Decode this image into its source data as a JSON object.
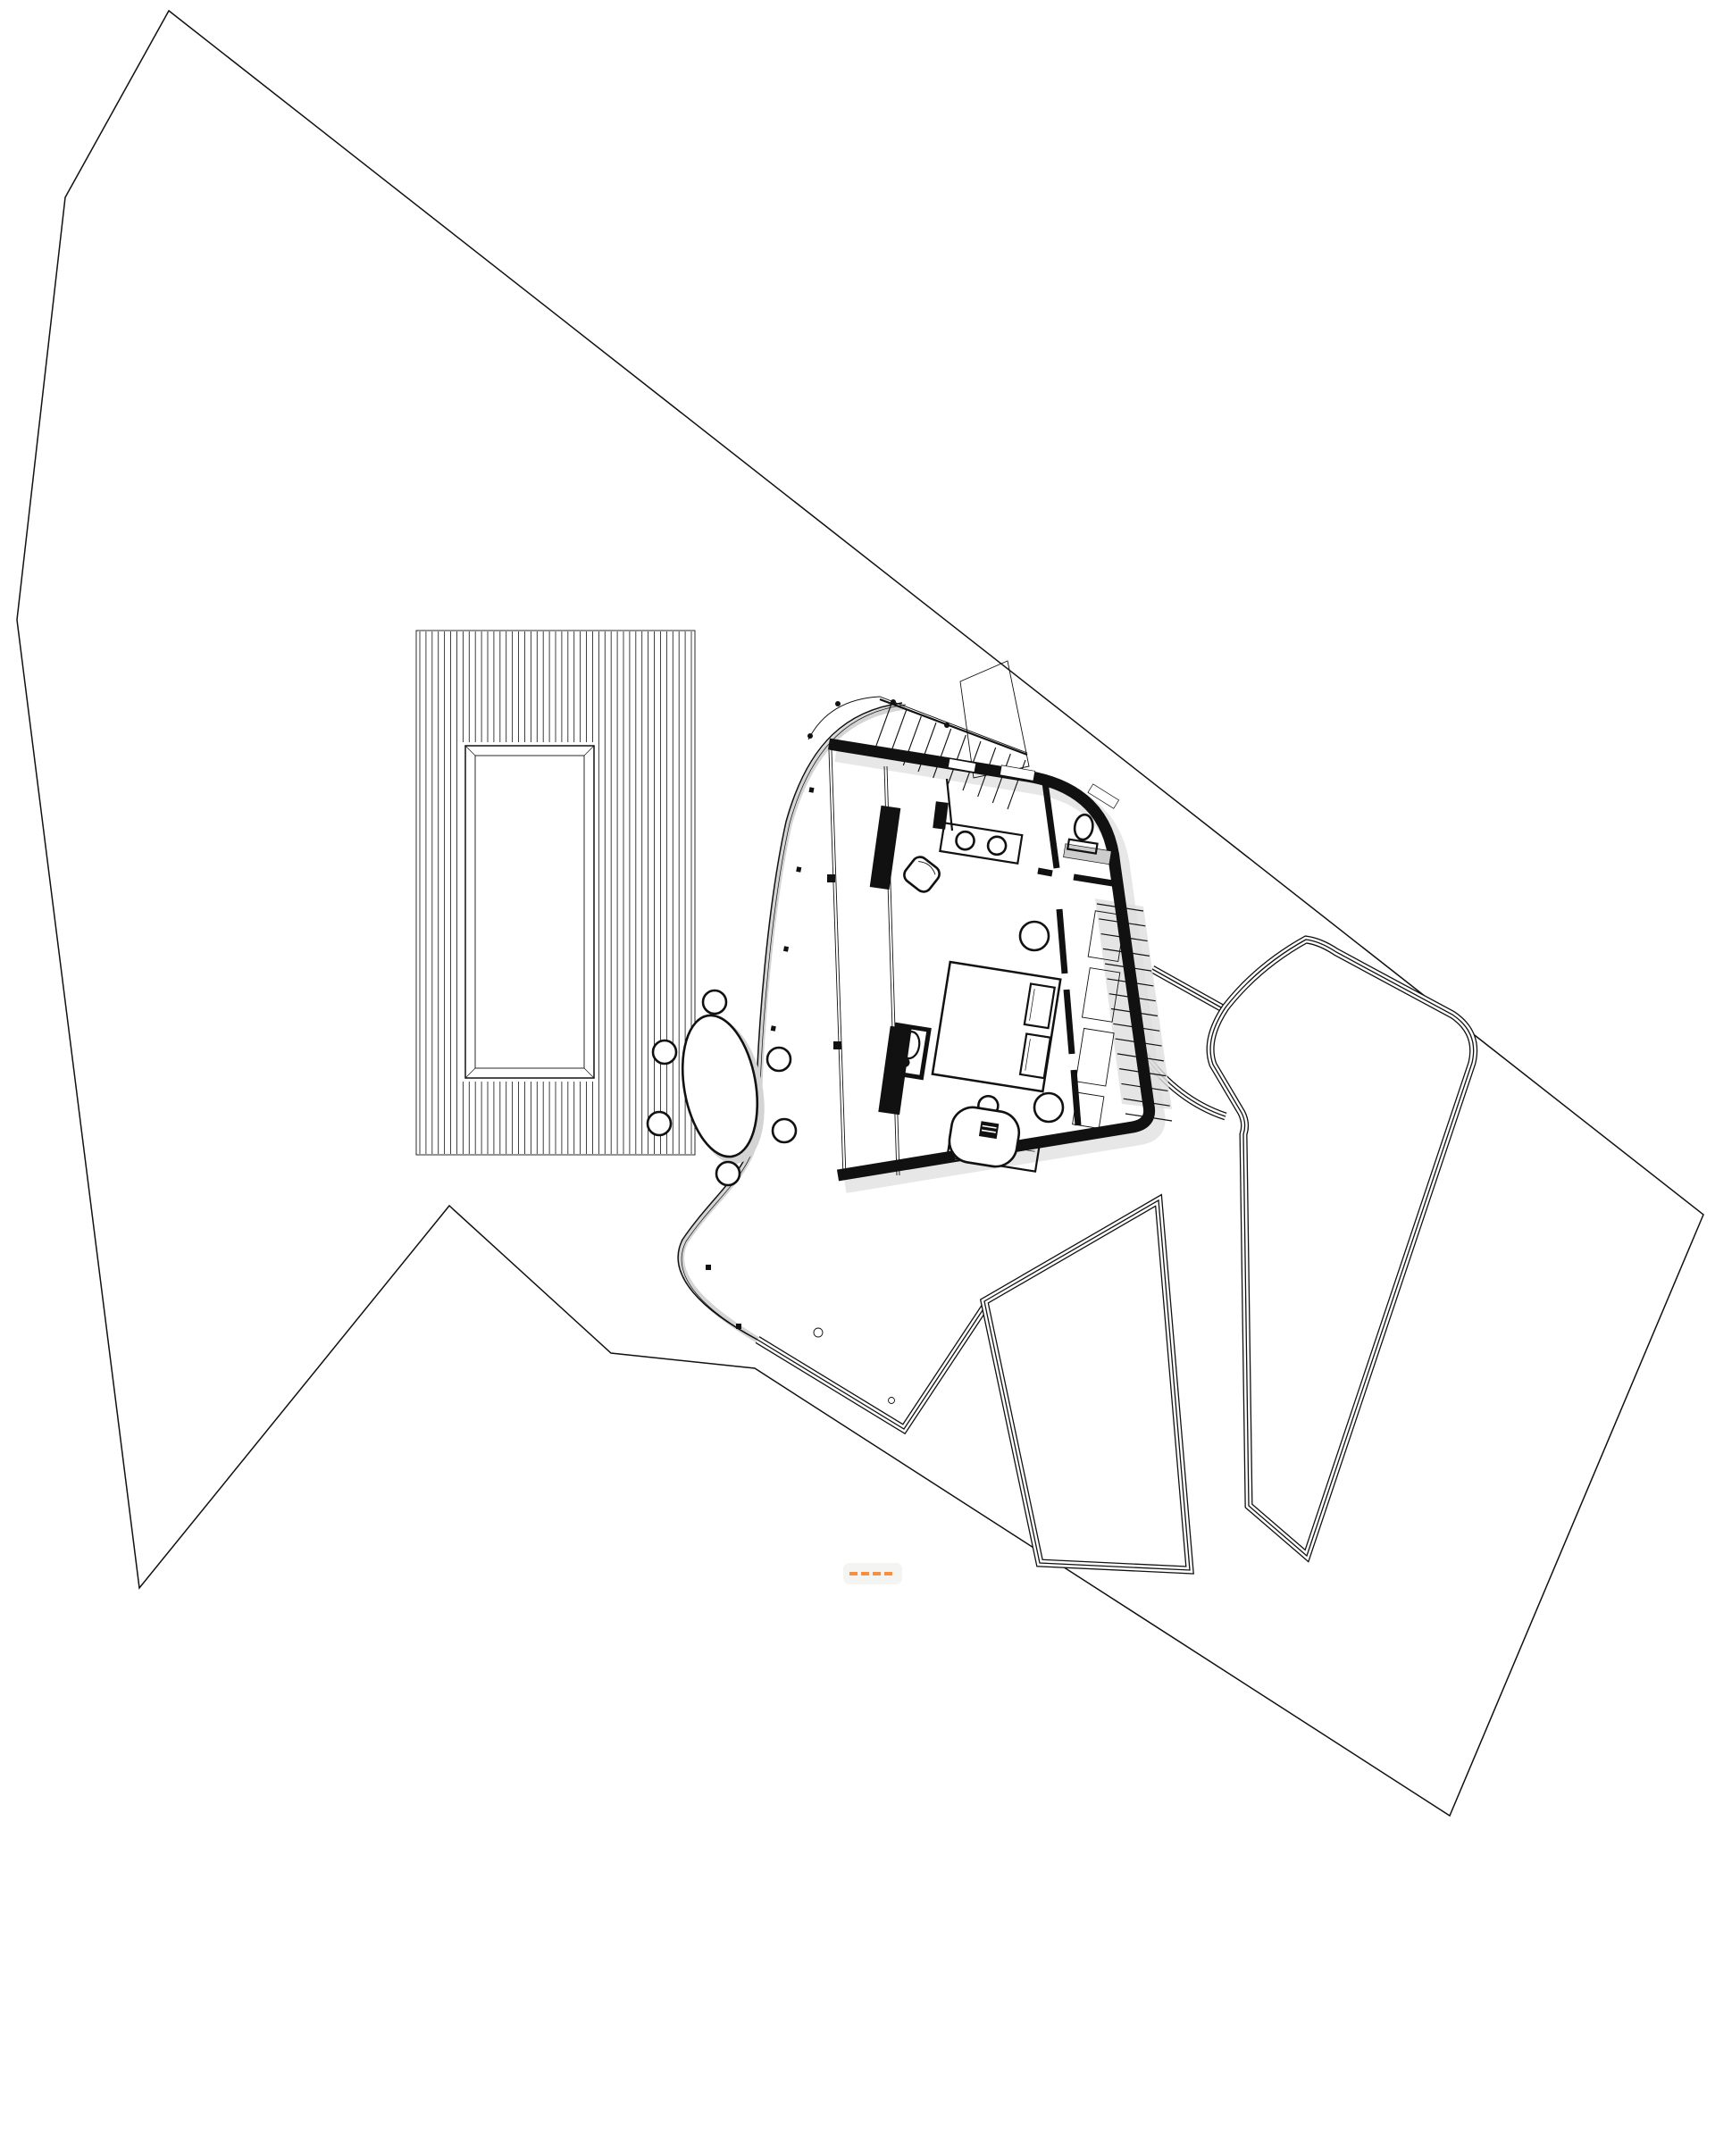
{
  "document": {
    "type": "architectural-site-plan",
    "description": "Black and white site plan of a small villa: property boundary, striped timber deck with rectangular pool, fan-shaped one-room house with furniture, curved terrace with oval dining table for six, lower patio with drains, two terraced garden beds connected by paths, exterior entry stair with railing and interior stair to lower level.",
    "visible_text": []
  },
  "colors": {
    "ink": "#111111",
    "paper": "#ffffff",
    "wall_fill": "#111111",
    "shadow": "#d4d4d4",
    "soft_shadow": "#e4e4e4",
    "stair_shading": "#dedede",
    "bath_mat": "#cccccc",
    "watermark_chip": "#f4f4f2",
    "watermark_accent": "#f78f3f"
  },
  "generate": {
    "deck_boards": {
      "count": 45
    },
    "entry_stair_treads": {
      "count": 10
    },
    "interior_stair_treads": {
      "count": 15
    },
    "terrace_posts": {
      "count": 5
    },
    "watermark_dashes": {
      "count": 4
    }
  },
  "inventory": {
    "site": [
      "property-boundary",
      "timber-deck",
      "deck-pool",
      "curved-terrace",
      "lower-patio",
      "garden-bed-small",
      "garden-bed-large",
      "garden-paths",
      "patio-drains"
    ],
    "house": [
      "exterior-walls",
      "entry-stair",
      "entry-railing",
      "entry-canopy",
      "bathroom",
      "toilet",
      "vanity-two-sinks",
      "armchair",
      "wardrobe-blocks",
      "glazed-west-wall",
      "bed",
      "pillows",
      "side-tables",
      "headboard-wall",
      "shelving",
      "interior-stair",
      "wash-basin",
      "bench",
      "bathtub-desk",
      "dining-table-six-chairs"
    ]
  }
}
